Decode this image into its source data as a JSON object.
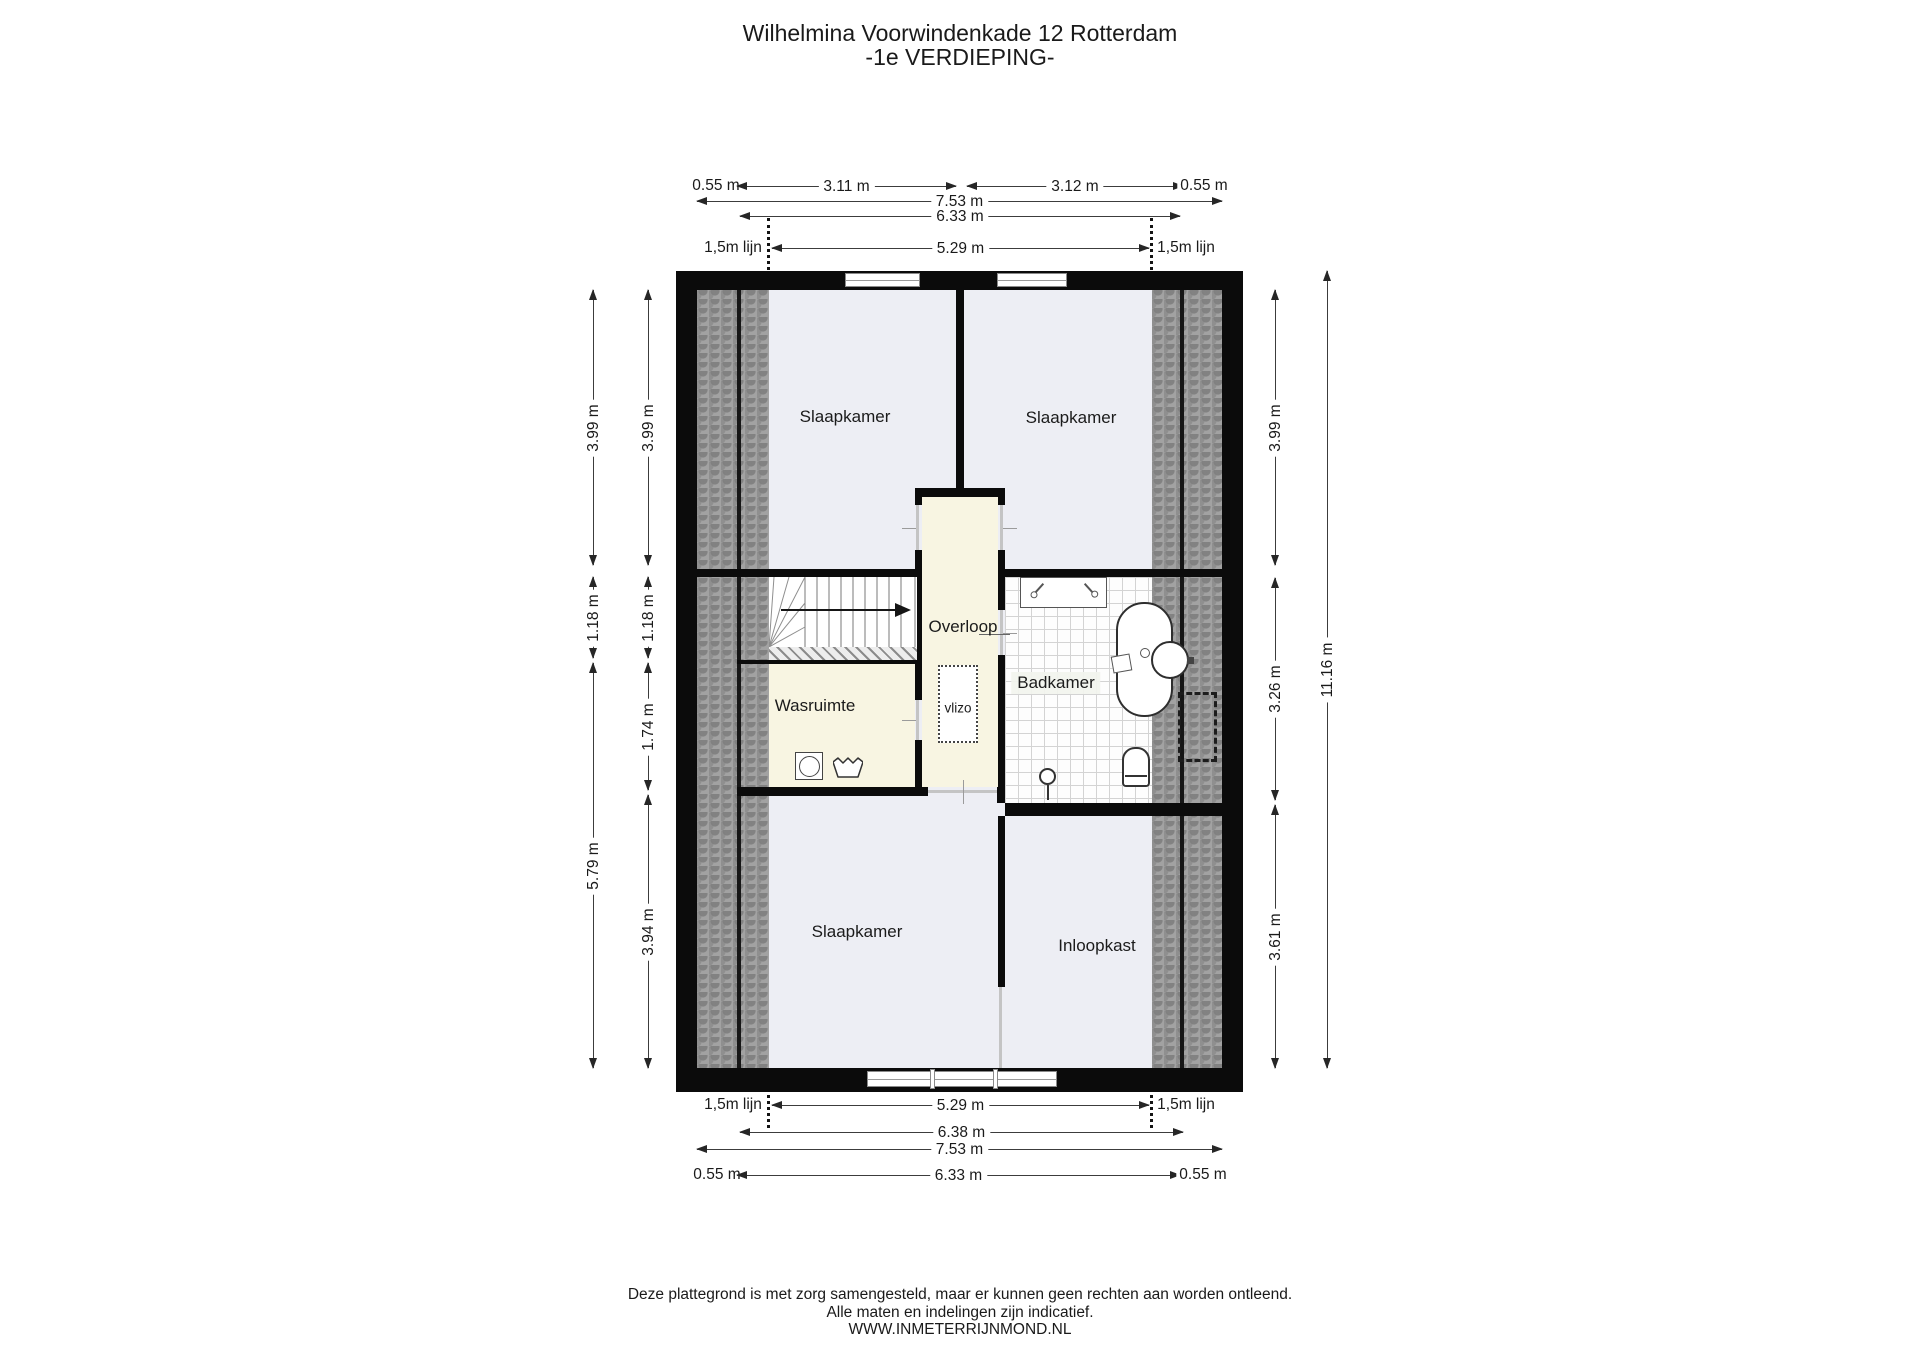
{
  "title": {
    "line1": "Wilhelmina Voorwindenkade 12 Rotterdam",
    "line2": "-1e VERDIEPING-"
  },
  "rooms": {
    "slaapkamer_top_left": "Slaapkamer",
    "slaapkamer_top_right": "Slaapkamer",
    "slaapkamer_bottom": "Slaapkamer",
    "overloop": "Overloop",
    "badkamer": "Badkamer",
    "wasruimte": "Wasruimte",
    "inloopkast": "Inloopkast",
    "vlizo": "vlizo"
  },
  "dimensions": {
    "top": {
      "offset_left": "0.55 m",
      "span_left": "3.11 m",
      "span_right": "3.12 m",
      "offset_right": "0.55 m",
      "total": "7.53 m",
      "inner": "6.33 m",
      "line_label_left": "1,5m lijn",
      "between_lines": "5.29 m",
      "line_label_right": "1,5m lijn"
    },
    "bottom": {
      "line_label_left": "1,5m lijn",
      "between_lines": "5.29 m",
      "line_label_right": "1,5m lijn",
      "inner_upper": "6.38 m",
      "total": "7.53 m",
      "offset_left": "0.55 m",
      "inner": "6.33 m",
      "offset_right": "0.55 m"
    },
    "left_outer": [
      "3.99 m",
      "1.18 m",
      "5.79 m"
    ],
    "left_inner": [
      "3.99 m",
      "1.18 m",
      "1.74 m",
      "3.94 m"
    ],
    "right_inner": [
      "3.99 m",
      "3.26 m",
      "3.61 m"
    ],
    "right_outer": [
      "11.16 m"
    ]
  },
  "footer": {
    "line1": "Deze plattegrond is met zorg samengesteld, maar er kunnen geen rechten aan worden ontleend.",
    "line2": "Alle maten en indelingen zijn indicatief.",
    "line3": "WWW.INMETERRIJNMOND.NL"
  },
  "colors": {
    "wall": "#0b0b0b",
    "bedroom_fill": "#edeef4",
    "landing_fill": "#f8f5e2",
    "hatch_fill": "#a2a2a2",
    "tile_line": "#d3d3d3",
    "dimension_text": "#1a1a1a"
  }
}
